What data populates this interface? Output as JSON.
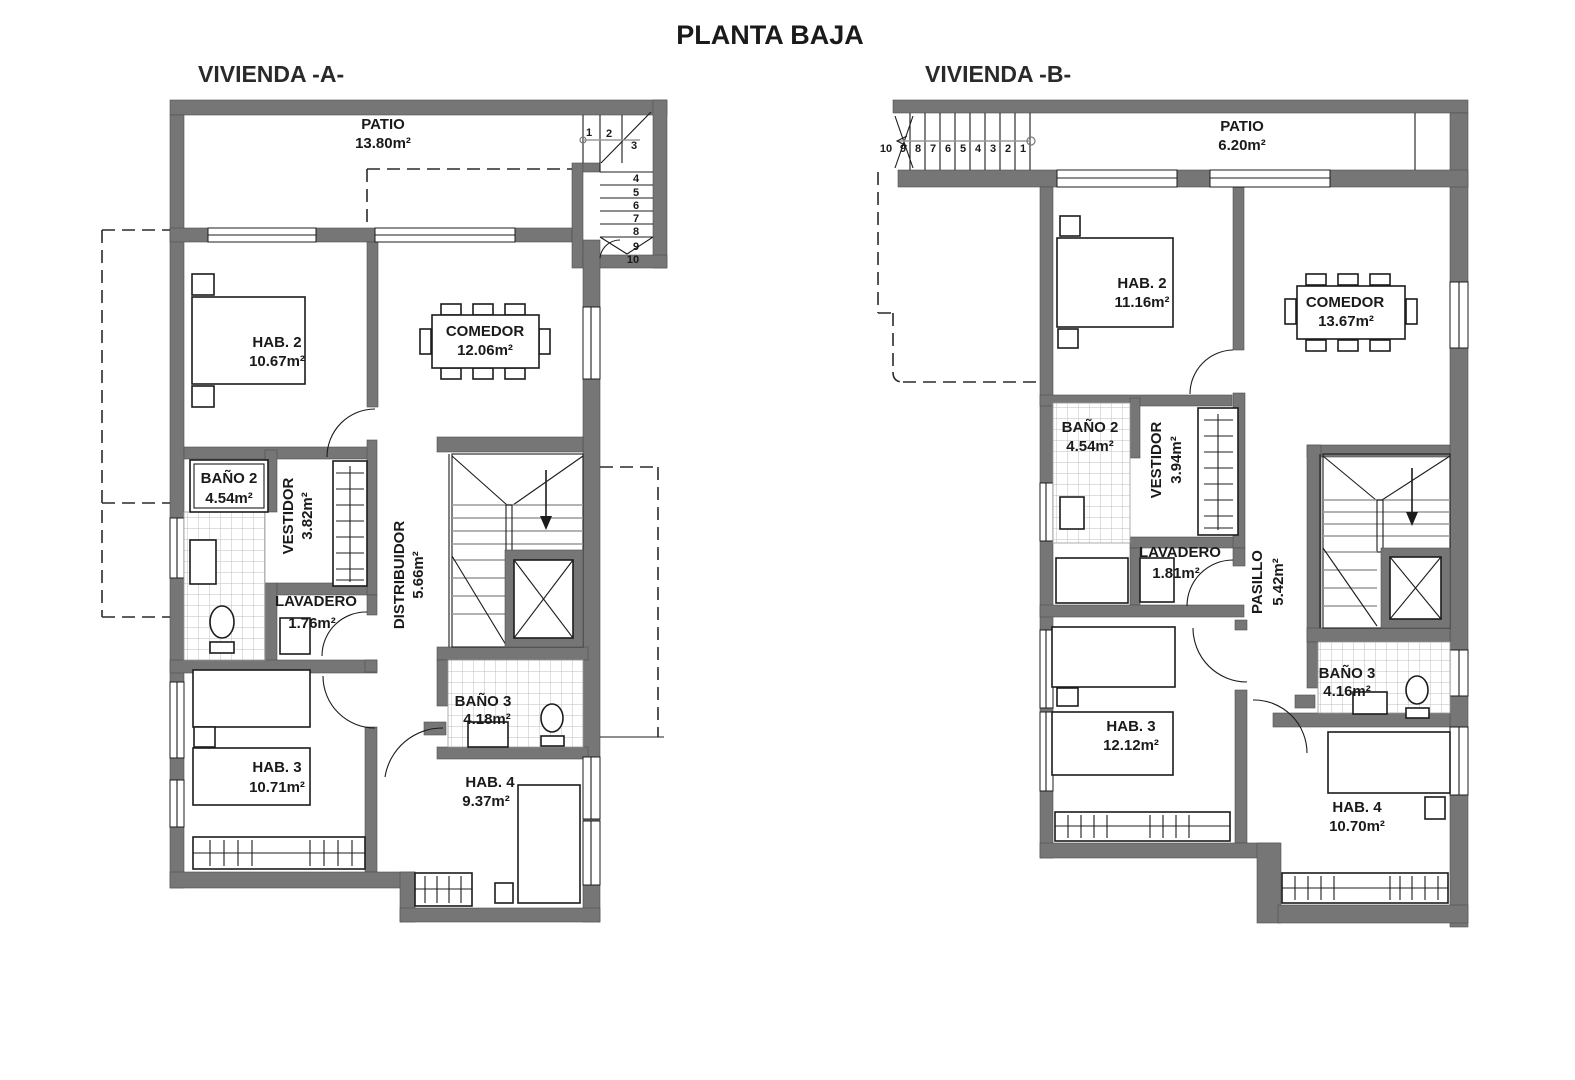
{
  "title": "PLANTA BAJA",
  "colors": {
    "background": "#ffffff",
    "wall": "#767676",
    "line": "#1c1c1c",
    "tread": "#9a9a9a",
    "tile_grid": "#bfbfbf",
    "text": "#1a1a1a"
  },
  "plan_a": {
    "name": "VIVIENDA -A-",
    "stairs": [
      "1",
      "2",
      "3",
      "4",
      "5",
      "6",
      "7",
      "8",
      "9",
      "10"
    ],
    "rooms": {
      "patio": {
        "label": "PATIO",
        "area": "13.80m²"
      },
      "hab2": {
        "label": "HAB. 2",
        "area": "10.67m²"
      },
      "comedor": {
        "label": "COMEDOR",
        "area": "12.06m²"
      },
      "bano2": {
        "label": "BAÑO 2",
        "area": "4.54m²"
      },
      "vestidor": {
        "label": "VESTIDOR",
        "area": "3.82m²"
      },
      "lavadero": {
        "label": "LAVADERO",
        "area": "1.76m²"
      },
      "distribuidor": {
        "label": "DISTRIBUIDOR",
        "area": "5.66m²"
      },
      "bano3": {
        "label": "BAÑO 3",
        "area": "4.18m²"
      },
      "hab3": {
        "label": "HAB. 3",
        "area": "10.71m²"
      },
      "hab4": {
        "label": "HAB. 4",
        "area": "9.37m²"
      }
    }
  },
  "plan_b": {
    "name": "VIVIENDA -B-",
    "stairs": [
      "10",
      "9",
      "8",
      "7",
      "6",
      "5",
      "4",
      "3",
      "2",
      "1"
    ],
    "rooms": {
      "patio": {
        "label": "PATIO",
        "area": "6.20m²"
      },
      "hab2": {
        "label": "HAB. 2",
        "area": "11.16m²"
      },
      "comedor": {
        "label": "COMEDOR",
        "area": "13.67m²"
      },
      "bano2": {
        "label": "BAÑO 2",
        "area": "4.54m²"
      },
      "vestidor": {
        "label": "VESTIDOR",
        "area": "3.94m²"
      },
      "lavadero": {
        "label": "LAVADERO",
        "area": "1.81m²"
      },
      "pasillo": {
        "label": "PASILLO",
        "area": "5.42m²"
      },
      "bano3": {
        "label": "BAÑO 3",
        "area": "4.16m²"
      },
      "hab3": {
        "label": "HAB. 3",
        "area": "12.12m²"
      },
      "hab4": {
        "label": "HAB. 4",
        "area": "10.70m²"
      }
    }
  }
}
